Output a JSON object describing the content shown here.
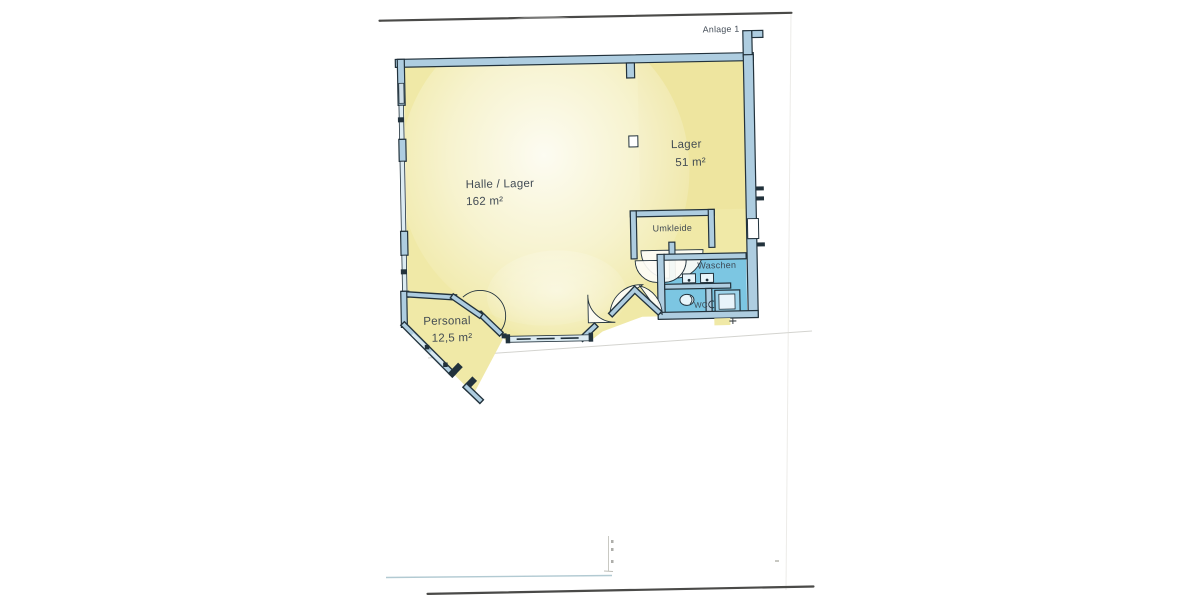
{
  "document": {
    "annotation": "Anlage 1"
  },
  "floor_plan": {
    "rooms": [
      {
        "name": "Halle / Lager",
        "area": "162 m²"
      },
      {
        "name": "Lager",
        "area": "51 m²"
      },
      {
        "name": "Umkleide",
        "area": ""
      },
      {
        "name": "Waschen",
        "area": ""
      },
      {
        "name": "WC",
        "area": ""
      },
      {
        "name": "Personal",
        "area": "12,5 m²"
      }
    ]
  },
  "colors": {
    "paper": "#ffffff",
    "room-yellow": "#f0e9a7",
    "room-yellow-deep": "#eadf92",
    "room-blue": "#7cc6e2",
    "wall-fill": "#aecde0",
    "glass-fill": "#dcebf2",
    "line": "#22323c",
    "label": "#39434e"
  }
}
